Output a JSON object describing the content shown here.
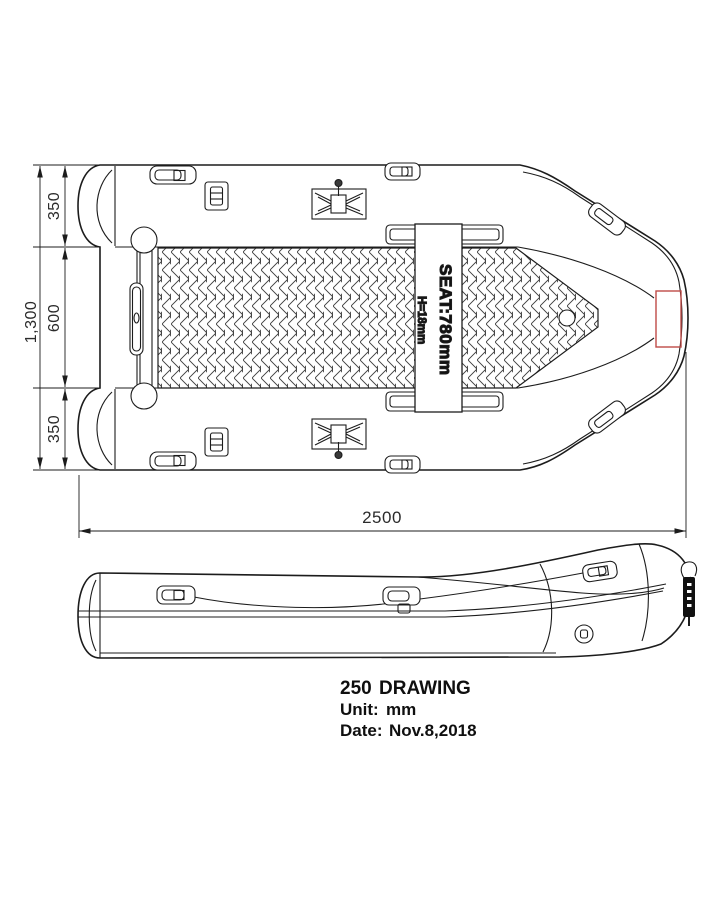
{
  "drawing_info": {
    "title_number": "250",
    "title_text": "DRAWING",
    "unit_label": "Unit:",
    "unit_value": "mm",
    "date_label": "Date:",
    "date_value": "Nov.8,2018"
  },
  "dimensions": {
    "overall_length": "2500",
    "overall_beam": "1,300",
    "tube_top": "350",
    "floor_width": "600",
    "tube_bottom": "350"
  },
  "seat": {
    "label": "SEAT:780mm",
    "height_label": "H=18mm"
  },
  "colors": {
    "line": "#1c1c1c",
    "red_accent": "#bf4b47",
    "background": "#ffffff"
  }
}
